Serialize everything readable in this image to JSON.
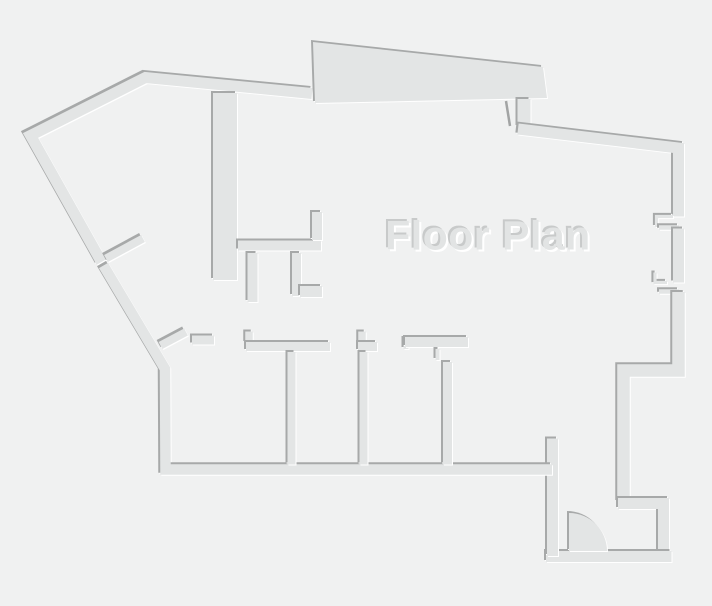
{
  "title": "Floor Plan",
  "colors": {
    "background": "#f0f1f1",
    "wall_fill": "#e3e5e5",
    "edge_dark": "#a7a9a9",
    "edge_light": "#ffffff",
    "title_text": "#e2e4e4"
  }
}
